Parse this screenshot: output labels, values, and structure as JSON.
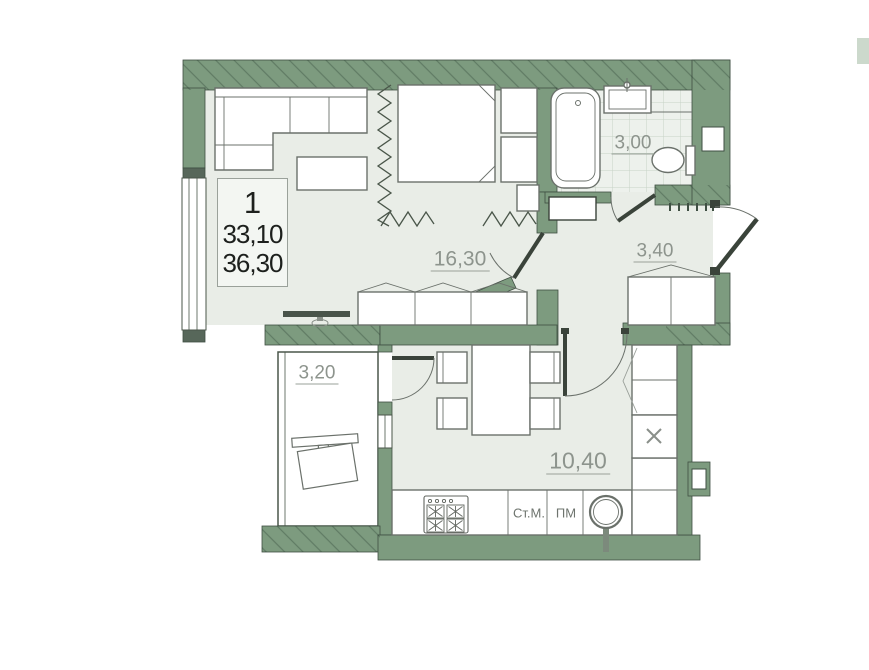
{
  "floorplan": {
    "info_box": {
      "rooms_count": "1",
      "living_area": "33,10",
      "total_area": "36,30"
    },
    "room_labels": {
      "living_room": "16,30",
      "bathroom": "3,00",
      "hallway": "3,40",
      "balcony": "3,20",
      "kitchen": "10,40"
    },
    "appliance_labels": {
      "washing_machine": "Ст.М.",
      "dishwasher": "ПМ"
    },
    "colors": {
      "wall": "#7d9b7f",
      "floor": "#e9ede7",
      "bathroom_floor": "#edf1ec",
      "balcony_floor": "#ffffff",
      "outline": "#3f4f43",
      "label_text": "#8d948d",
      "info_text": "#1d201d"
    }
  }
}
